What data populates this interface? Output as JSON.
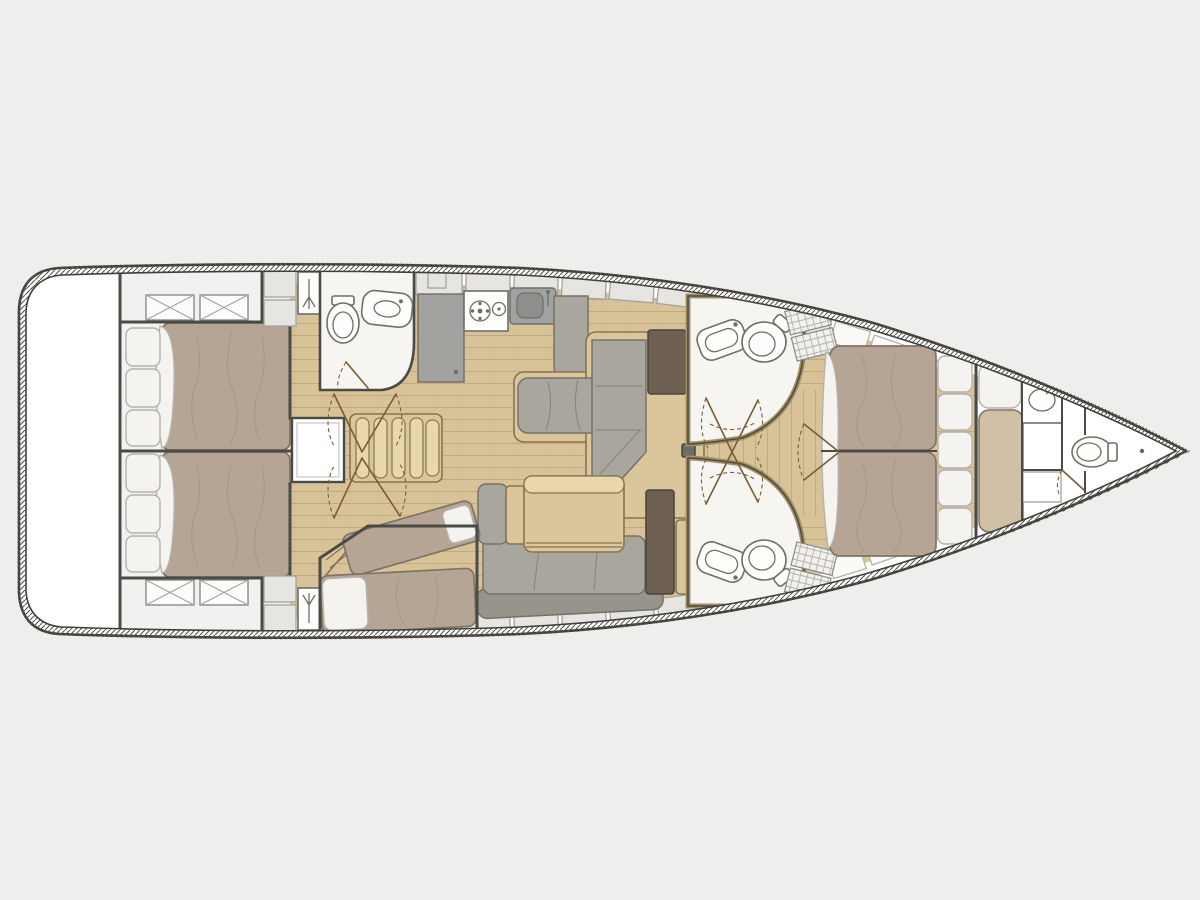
{
  "page": {
    "background": "#efeeec"
  },
  "colors": {
    "bg": "#efeeec",
    "hull": "#3f3f3b",
    "wall": "#4b4b46",
    "rimtick": "#55544e",
    "room": "#f6f5f2",
    "aftfloor": "#f2f1ef",
    "locker": "#e6e5e2",
    "lockerline": "#a3a29e",
    "wood": "#d8c298",
    "woodline": "#c3aa7e",
    "furn": "#dbc69c",
    "furnlight": "#e8d6ad",
    "furnline": "#86744f",
    "uph": "#a9a69e",
    "uphdark": "#97948b",
    "uphline": "#777268",
    "mat": "#b6a595",
    "matline": "#7e7366",
    "fpmat": "#cfc0a6",
    "cushion": "#f5f3ef",
    "cushline": "#b5b2ab",
    "appl": "#a2a2a0",
    "appldark": "#8e8e8c",
    "applline": "#6e6e6a",
    "chart": "#6e6154",
    "fixture": "#6f6f69",
    "door": "#7a5c35",
    "grateline": "#b3b1ac"
  },
  "vessel": {
    "type": "sailing-yacht-interior-floor-plan",
    "orientation": "bow-right",
    "rooms": [
      "transom-platform",
      "aft-cabin-port",
      "aft-cabin-starboard",
      "aft-head",
      "galley",
      "companionway",
      "nav-station",
      "bunk-cabin",
      "salon",
      "forward-head-port",
      "forward-head-starboard",
      "owner-cabin",
      "forepeak-cabin",
      "bow-head"
    ],
    "fixtures": [
      "double-bed",
      "single-berth",
      "pillow",
      "toilet",
      "washbasin",
      "stove",
      "galley-sink",
      "refrigerator",
      "sofa",
      "saloon-table",
      "chart-table",
      "companionway-stairs",
      "deck-hatch",
      "deck-locker",
      "door-swing",
      "mast-step",
      "shower-grate",
      "deck-shower"
    ]
  }
}
